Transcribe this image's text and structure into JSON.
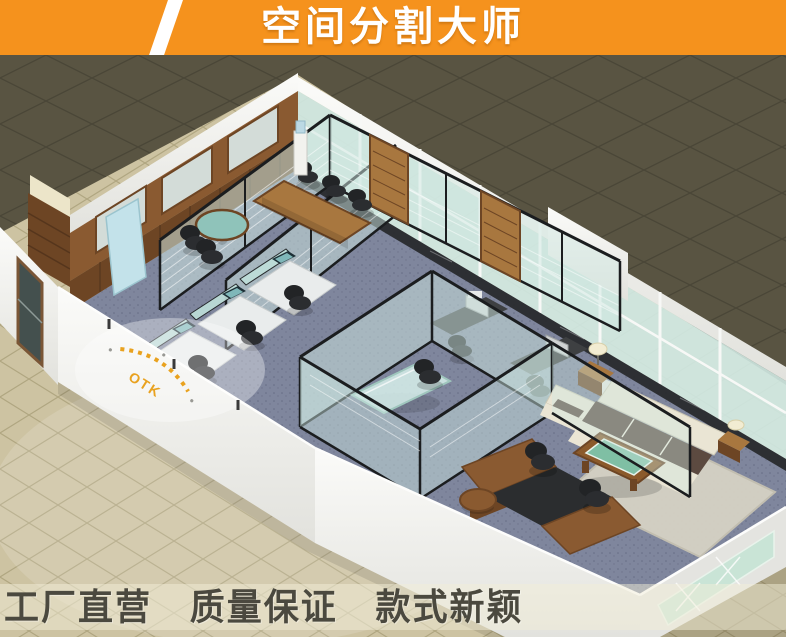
{
  "banner": {
    "title": "空间分割大师"
  },
  "scene": {
    "logo_text": "OTK"
  },
  "footer": {
    "slogans": [
      "工厂直营",
      "质量保证",
      "款式新颖"
    ]
  },
  "theme_colors": {
    "banner_bg": "#f5921d",
    "banner_stripe": "#ffffff",
    "banner_text": "#ffffff",
    "slogan_band": "rgba(242,237,216,0.5)",
    "slogan_text": "#4b493f",
    "floor_dark": "#595442",
    "floor_dark_line": "#4a4637",
    "floor_beige": "#cdc3a2",
    "floor_beige_line": "#b0a681",
    "wall": "#f3f3f0",
    "wall_dim": "#e4e4e0",
    "wood": "#8a5a31",
    "wood_dark": "#6d4524",
    "wood_light": "#a8773f",
    "carpet": "#7f869d",
    "glass": "#cfe8e2",
    "frame": "#1b1d1f",
    "marble": "#26282a",
    "white_frame": "#f7f8f6",
    "sofa": "#eae5d4",
    "cushion": "#5c4a40",
    "rug": "#d6d2c4",
    "table_green": "#7fbfa4",
    "chair": "#2b2d30",
    "screen": "#7fb7b9",
    "logo_orange": "#e9a21f",
    "frosted": "#d3dcd8",
    "poster_blue": "#c3e2ea",
    "lamp": "#f2ecd2",
    "door_glass": "#44504e"
  }
}
